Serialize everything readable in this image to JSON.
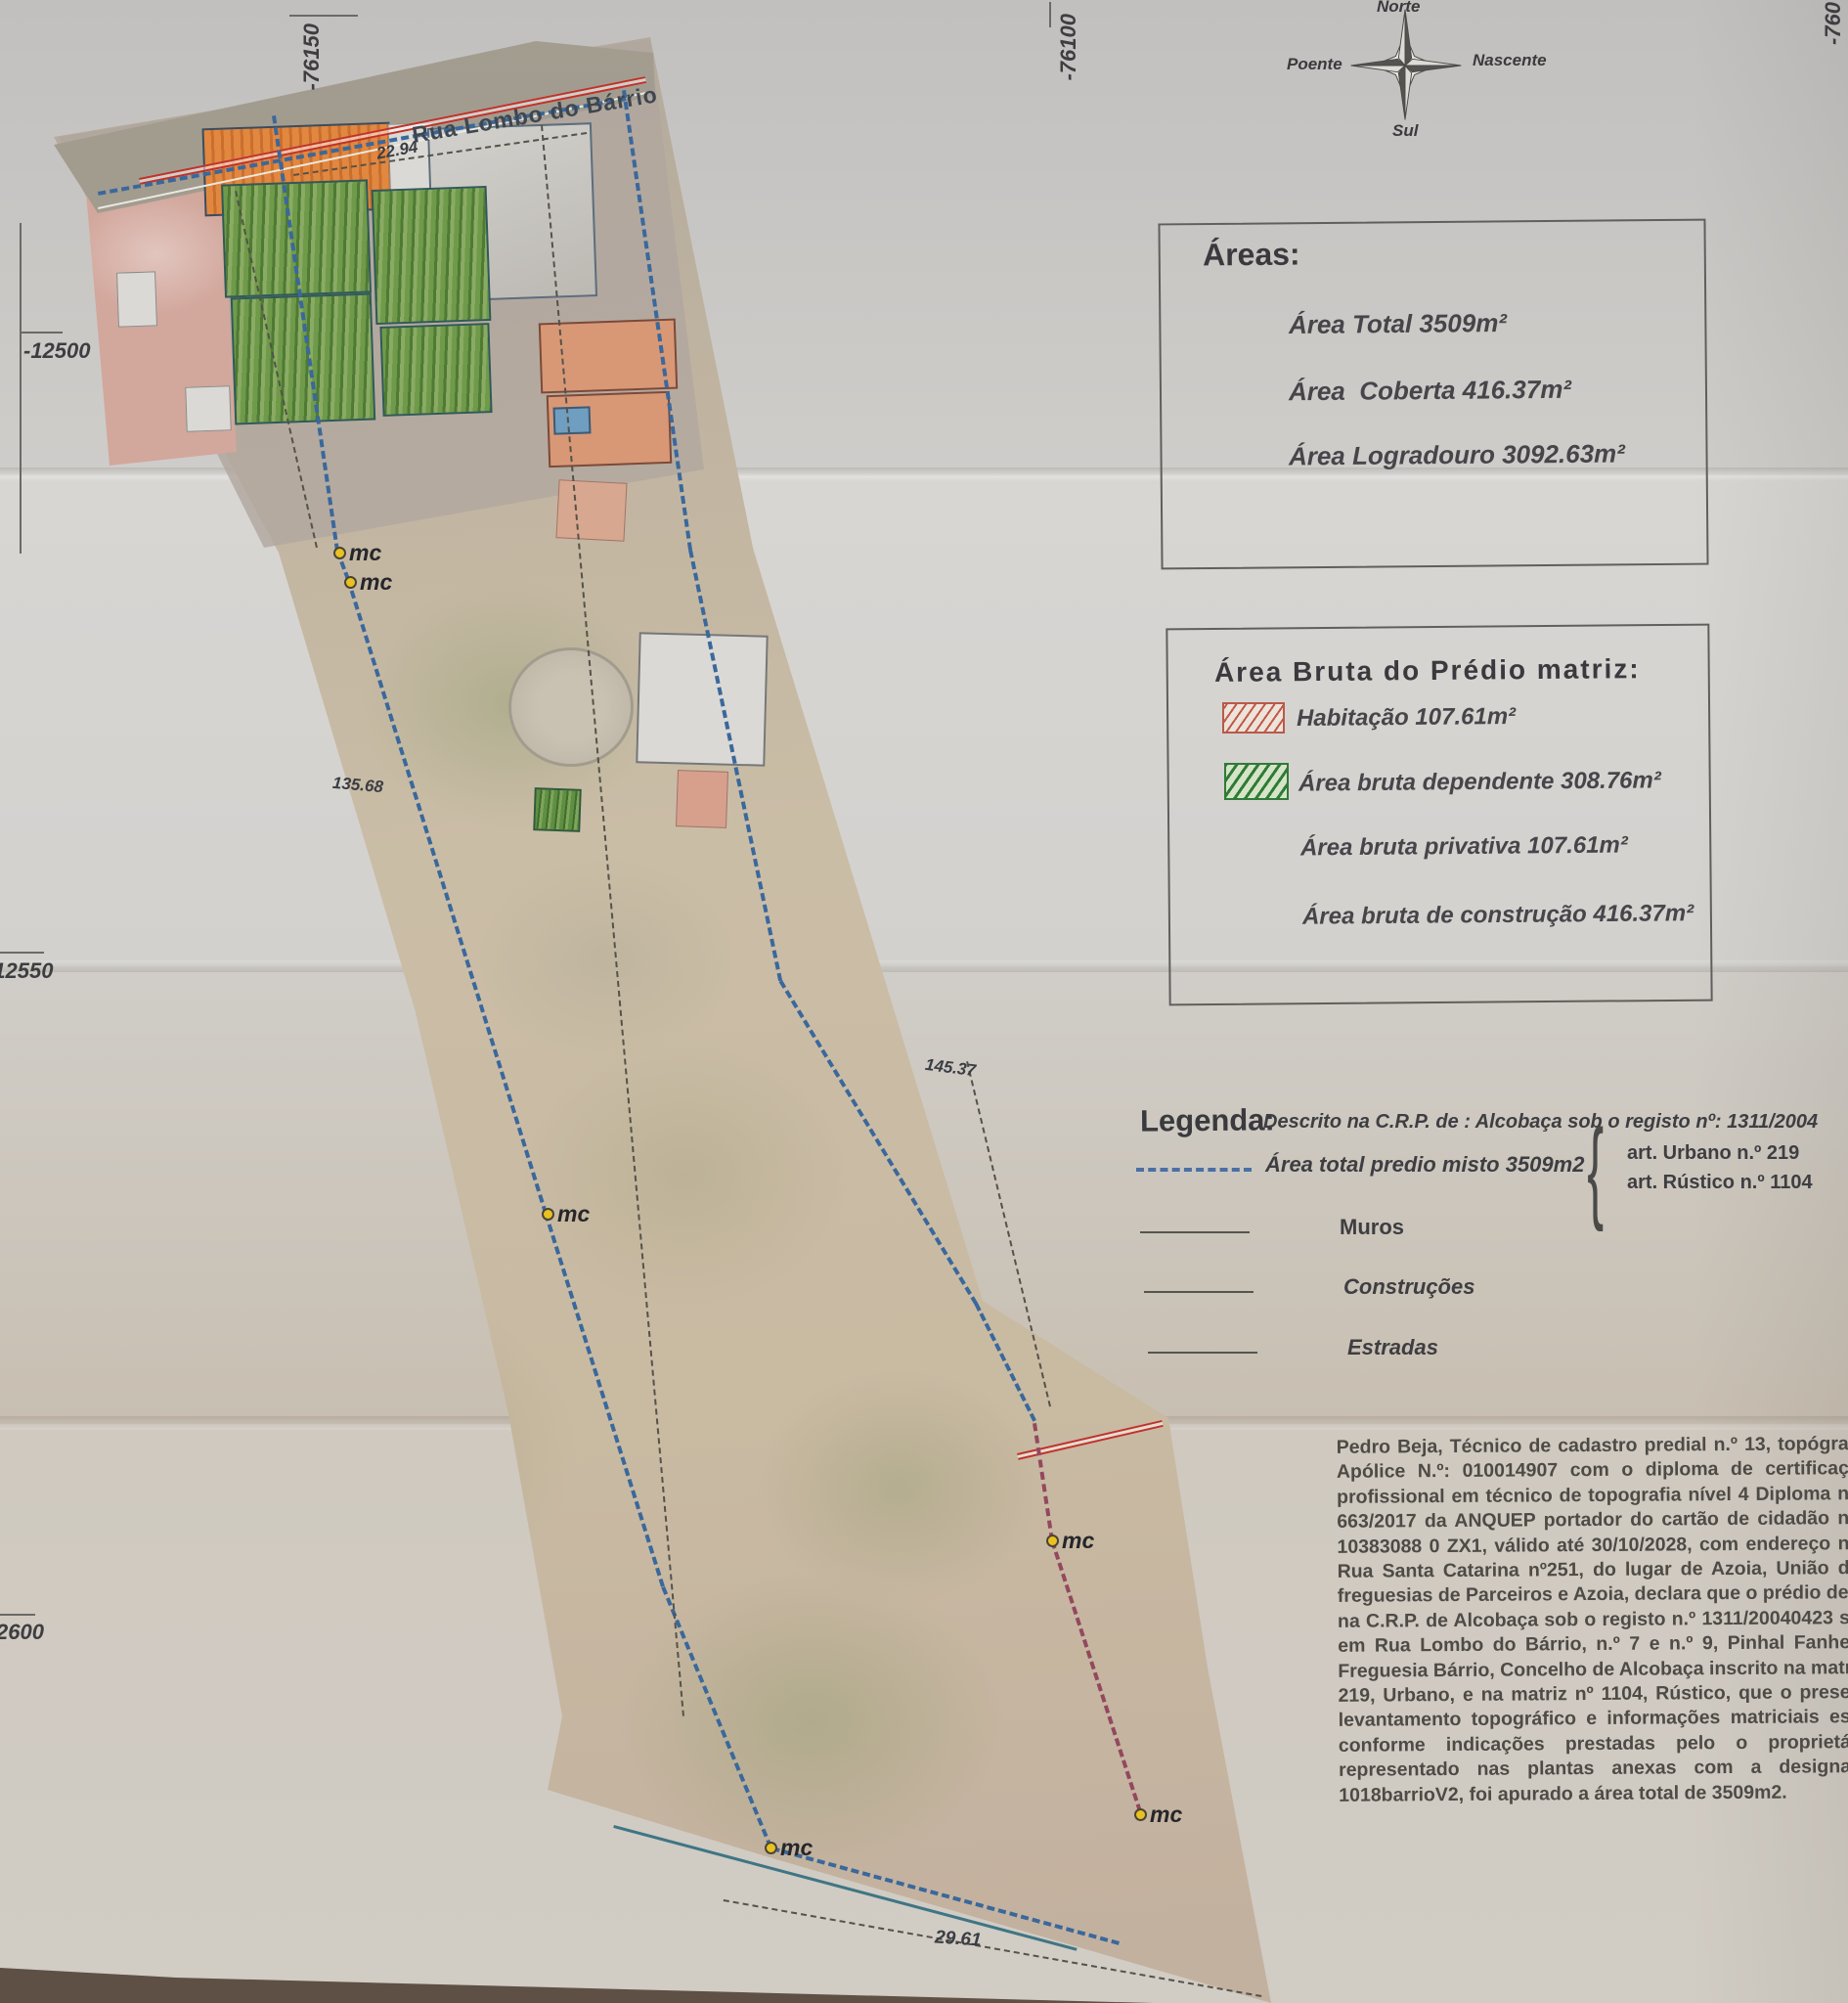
{
  "coords": {
    "top_left": "-76150",
    "top_mid": "-76100",
    "top_right": "-760",
    "left_upper": "-12500",
    "left_mid": "-12550",
    "left_lower": "2600"
  },
  "compass": {
    "north": "Norte",
    "south": "Sul",
    "west": "Poente",
    "east": "Nascente"
  },
  "map": {
    "street": "Rua Lombo do Bárrio",
    "marker": "mc",
    "dim_top": "22.94",
    "dim_left": "135.68",
    "dim_right": "145.37",
    "dim_bottom": "29.61"
  },
  "areas_box": {
    "title": "Áreas:",
    "total": "Área Total 3509m²",
    "coberta": "Área  Coberta 416.37m²",
    "logradouro": "Área Logradouro 3092.63m²"
  },
  "bruta_box": {
    "title": "Área Bruta do Prédio matriz:",
    "habitacao": "Habitação 107.61m²",
    "dependente": "Área bruta dependente 308.76m²",
    "privativa": "Área bruta privativa 107.61m²",
    "construcao": "Área bruta de construção 416.37m²"
  },
  "legend": {
    "title": "Legenda:",
    "descrito": "Descrito na C.R.P. de : Alcobaça sob o registo nº: 1311/2004",
    "art_urbano": "art.  Urbano n.º 219",
    "art_rustico": "art.  Rústico n.º 1104",
    "area_total": "Área total predio misto 3509m2",
    "muros": "Muros",
    "construcoes": "Construções",
    "estradas": "Estradas"
  },
  "statement": {
    "lines": [
      "Pedro Beja, Técnico de cadastro predial n.º 13, topógra",
      "Apólice N.º: 010014907 com o diploma de certificaç",
      "profissional em técnico de topografia nível 4 Diploma n",
      "663/2017 da ANQUEP portador do cartão de cidadão n",
      "10383088 0 ZX1, válido até 30/10/2028, com endereço n",
      "Rua Santa Catarina nº251, do lugar de Azoia, União d",
      "freguesias de Parceiros e Azoia, declara que o prédio descr",
      "na C.R.P. de Alcobaça sob o registo n.º 1311/20040423 s",
      "em Rua Lombo do Bárrio, n.º 7 e n.º 9, Pinhal Fanhe",
      "Freguesia Bárrio, Concelho de Alcobaça inscrito na matriz",
      "219, Urbano, e na matriz nº 1104, Rústico,  que o prese",
      "levantamento topográfico e informações matriciais es",
      "conforme indicações prestadas pelo o proprietá",
      "representado nas plantas anexas com a designa",
      "1018barrioV2, foi apurado a área total de 3509m2."
    ]
  },
  "colors": {
    "boundary_blue": "#3a689c",
    "boundary_red_purple": "#93485e",
    "road_red": "#c0322a",
    "marker_yellow": "#e9c21f",
    "habitacao_hatch": "#c25848",
    "dependente_hatch": "#2f7a38"
  }
}
